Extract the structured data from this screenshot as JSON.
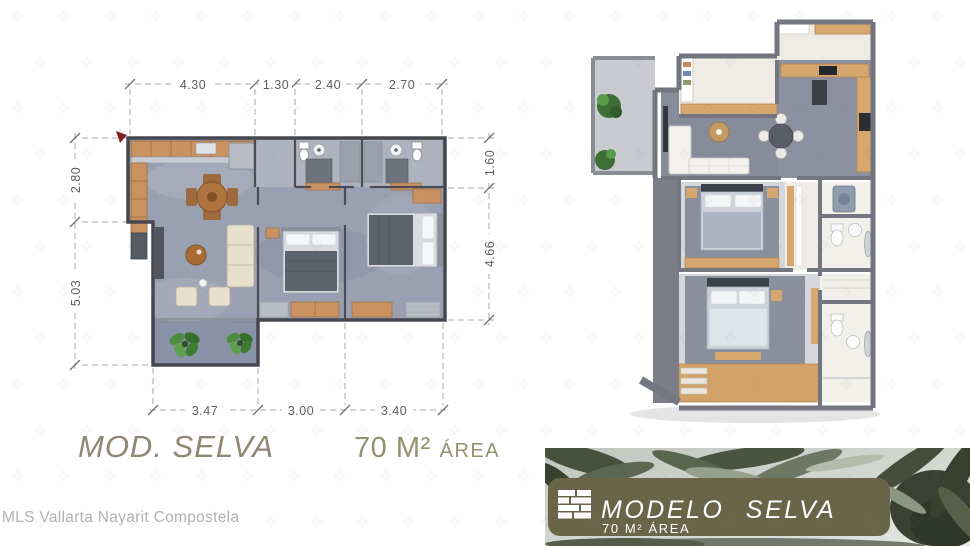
{
  "plan": {
    "title": "MOD. SELVA",
    "area_value": "70 M²",
    "area_label": "ÁREA",
    "dims_top": [
      "4.30",
      "1.30",
      "2.40",
      "2.70"
    ],
    "dims_bottom": [
      "3.47",
      "3.00",
      "3.40"
    ],
    "dims_left": [
      "2.80",
      "5.03"
    ],
    "dims_right": [
      "1.60",
      "4.66"
    ]
  },
  "banner": {
    "model_label": "MODELO SELVA",
    "area_label": "70 M² ÁREA",
    "accent_color": "#6a6549",
    "logo_icon": "planks-logo"
  },
  "watermark": {
    "text": "MLS Vallarta Nayarit Compostela",
    "glyph": "❖"
  },
  "colors": {
    "title_text": "#8e8875",
    "area_text": "#92916f",
    "plan_wall": "#46464e",
    "plan_floor": "#99a0b1",
    "wood": "#cb9261",
    "render_wall": "#73757f",
    "plant_green": "#4c8c3f",
    "banner_leaf_dark": "#3a4133"
  }
}
